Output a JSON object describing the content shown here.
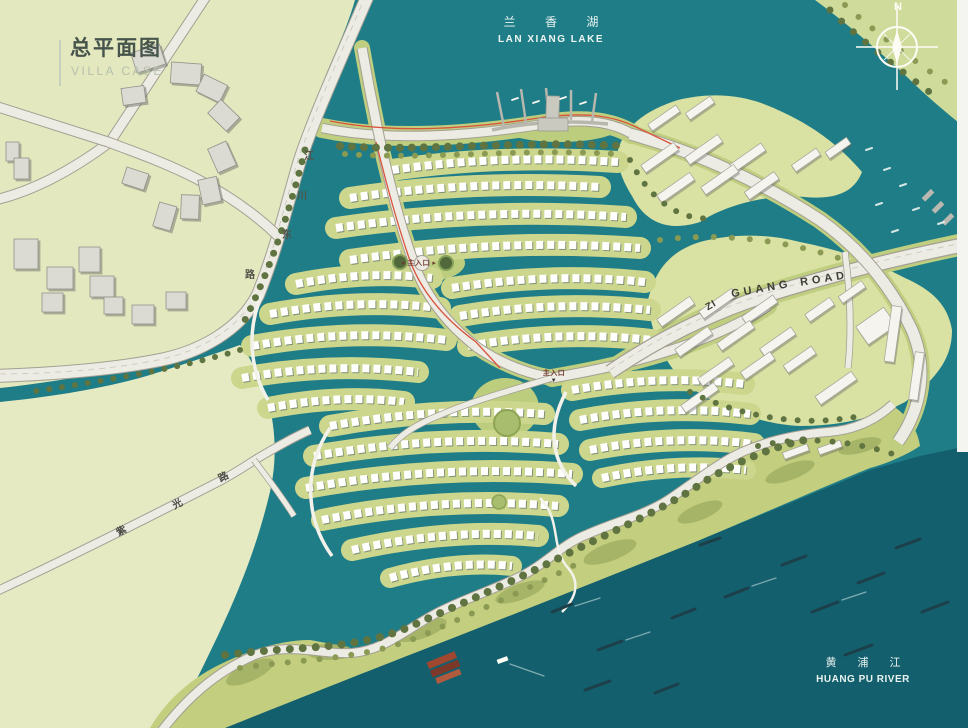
{
  "header": {
    "title_cn": "总平面图",
    "title_en": "VILLA CASE"
  },
  "labels": {
    "lake": {
      "cn": "兰 香 湖",
      "en": "LAN XIANG LAKE"
    },
    "river": {
      "cn": "黄 浦 江",
      "en": "HUANG PU RIVER"
    },
    "compass_north": "N",
    "road_guang": {
      "prefix": "ZI",
      "word1": "GUANG",
      "word2": "ROAD"
    },
    "road_jiangchuan": {
      "c0": "江",
      "c1": "川",
      "c2": "东",
      "c3": "路"
    },
    "road_ziguang": {
      "c0": "紫",
      "c1": "光",
      "c2": "路"
    },
    "entrance1": {
      "arrow_left": "◂",
      "text": "主入口",
      "arrow_right": "▸"
    },
    "entrance2": {
      "text": "主入口",
      "arrow_down": "▼"
    }
  },
  "colors": {
    "water": "#1f7d87",
    "river": "#135f6d",
    "land_pale": "#e3e8bf",
    "land_right": "#d9e1a3",
    "coast_band": "#c3ce7e",
    "island_band": "#ccd78d",
    "road_fill": "#edece4",
    "boundary_red": "#d9543e"
  }
}
